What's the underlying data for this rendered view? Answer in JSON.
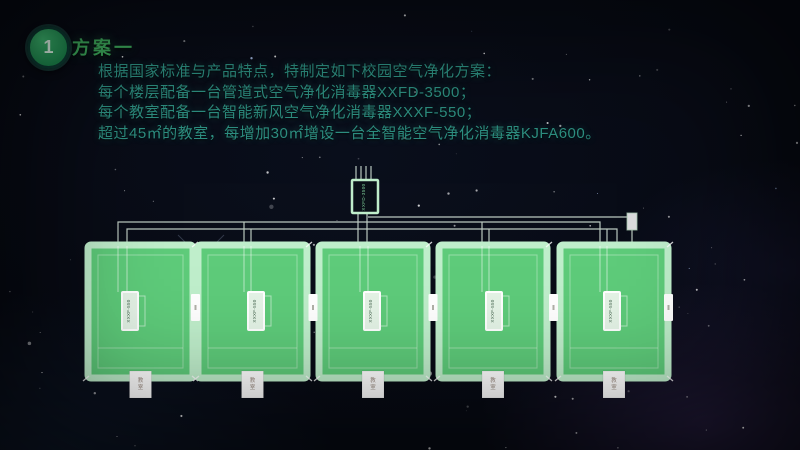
{
  "slide": {
    "badge": "1",
    "title": "方案一",
    "paragraph_lines": [
      "根据国家标准与产品特点，特制定如下校园空气净化方案：",
      "每个楼层配备一台管道式空气净化消毒器XXFD-3500；",
      "每个教室配备一台智能新风空气净化消毒器XXXF-550；",
      "超过45㎡的教室，每增加30㎡增设一台全智能空气净化消毒器KJFA600。"
    ]
  },
  "diagram": {
    "central_unit_label": "XXFD-3500",
    "classrooms": [
      {
        "unit_label": "XXXF-550",
        "room_label": "教室"
      },
      {
        "unit_label": "XXXF-550",
        "room_label": "教室"
      },
      {
        "unit_label": "XXXF-550",
        "room_label": "教室"
      },
      {
        "unit_label": "XXXF-550",
        "room_label": "教室"
      },
      {
        "unit_label": "XXXF-550",
        "room_label": "教室"
      }
    ]
  },
  "colors": {
    "accent_green": "#3fae5e",
    "body_text": "#2e9183",
    "room_fill": "#5ecb7a",
    "room_border": "#bfeecb",
    "pipe_line": "#d9e9dd",
    "unit_box_fill": "#0a1018",
    "label_box_fill": "#ffffff"
  }
}
